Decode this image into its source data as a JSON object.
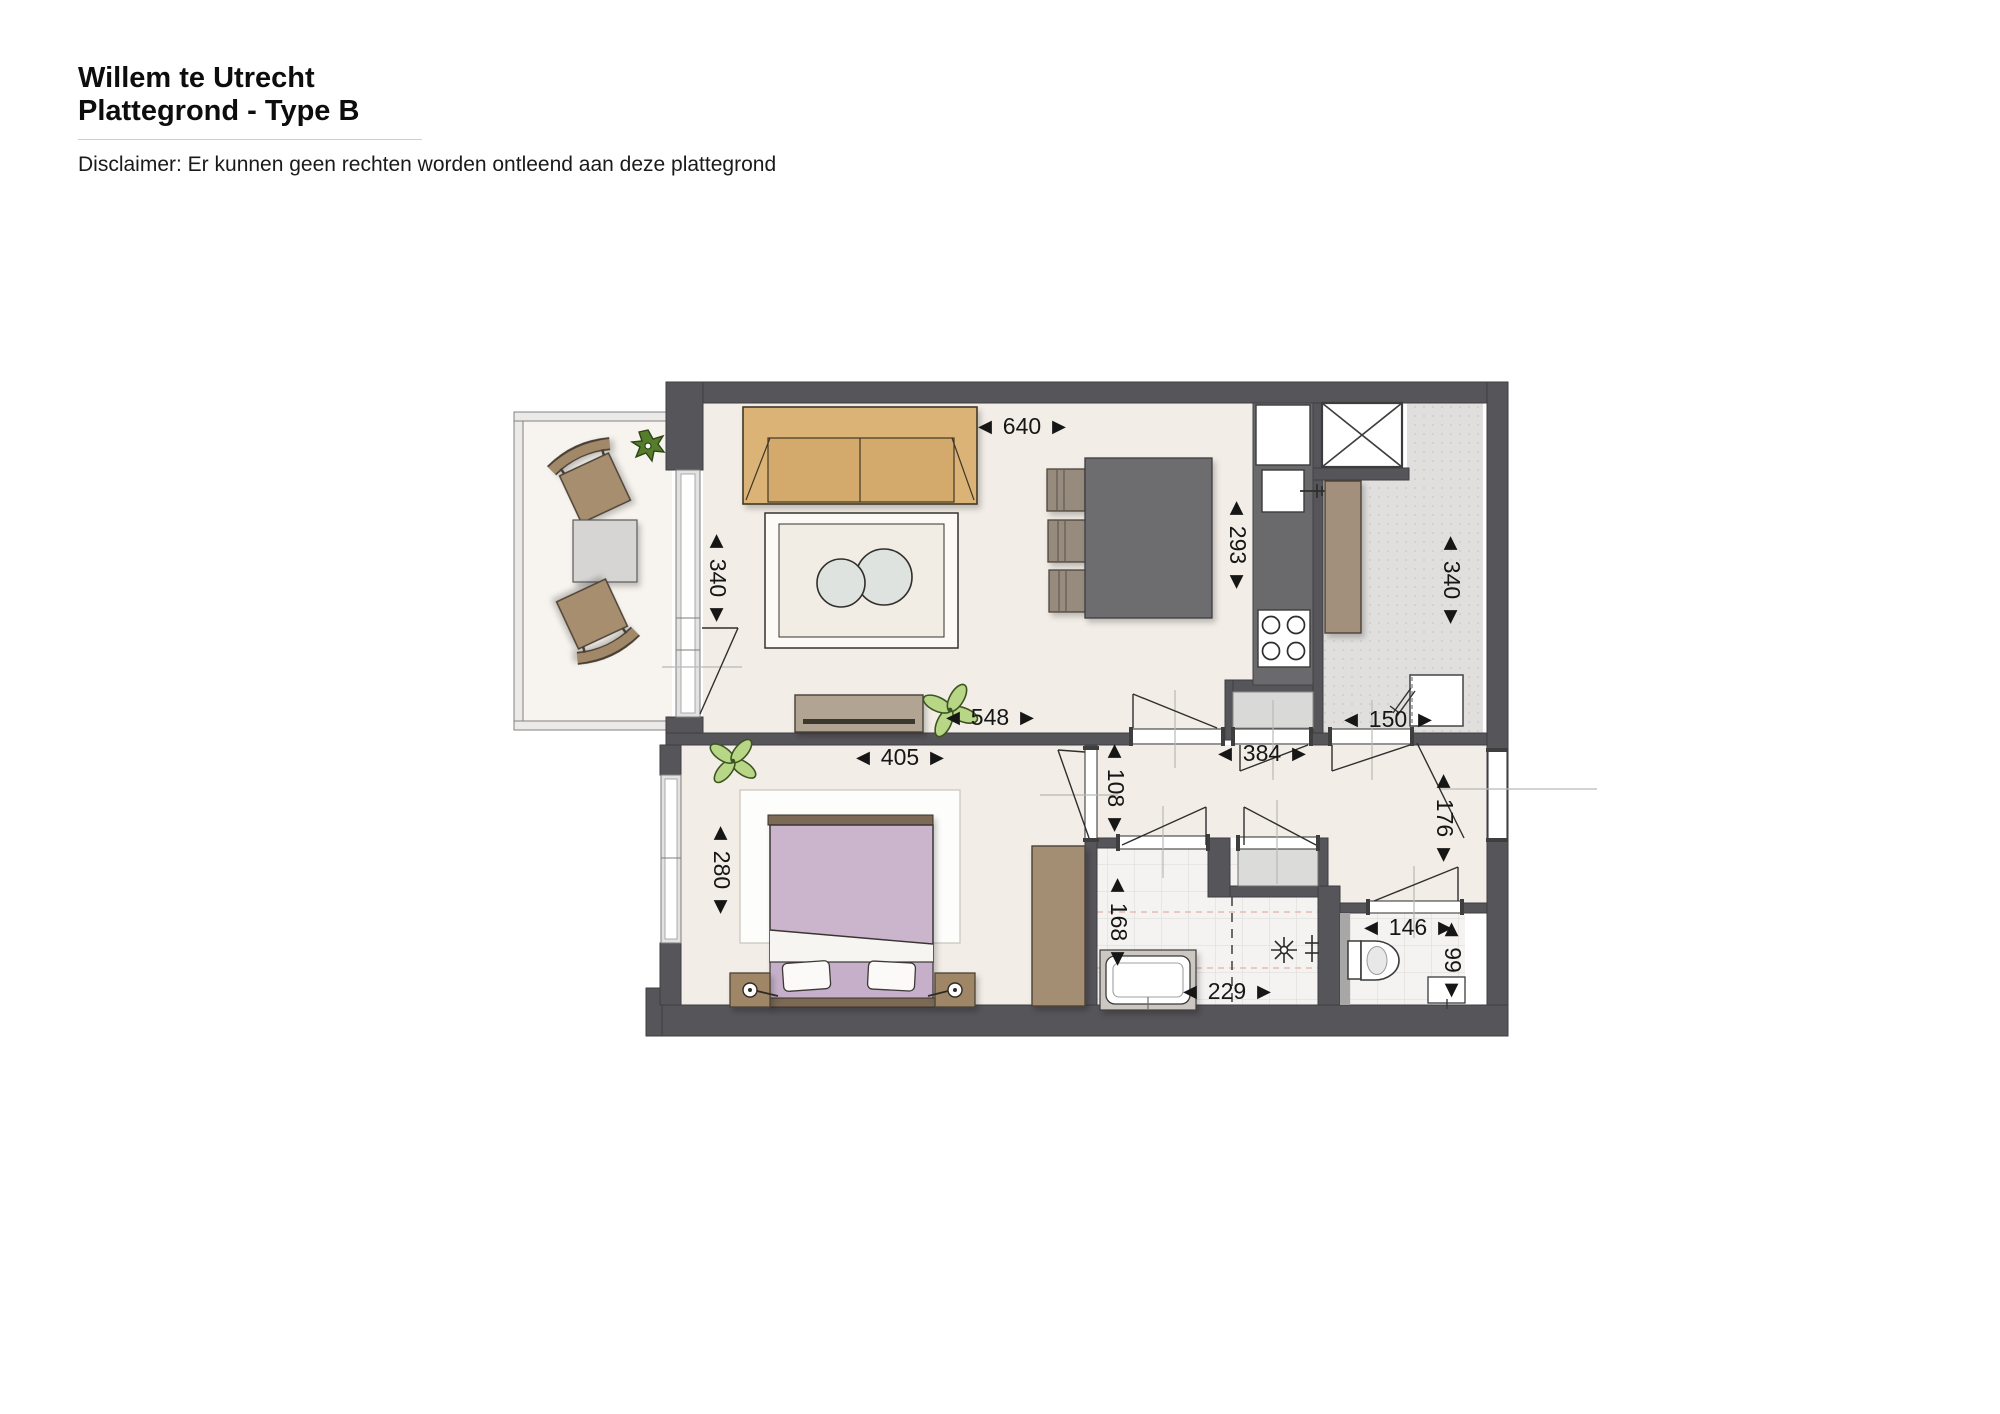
{
  "header": {
    "title_line1": "Willem te Utrecht",
    "title_line2": "Plattegrond - Type B",
    "disclaimer": "Disclaimer: Er kunnen geen rechten worden ontleend aan deze plattegrond"
  },
  "floorplan": {
    "dimension_labels": {
      "living_width": "◄ 640 ►",
      "living_depth": "◄ 340 ►",
      "kitchen_depth": "◄ 293 ►",
      "storage_depth": "◄ 340 ►",
      "living_bottom_span": "◄ 548 ►",
      "washer_niche_width": "◄ 150 ►",
      "bedroom_width": "◄ 405 ►",
      "hall_length": "◄ 384 ►",
      "hall_width": "◄ 108 ►",
      "entry_depth": "◄ 176 ►",
      "bedroom_depth": "◄ 280 ►",
      "bathroom_depth": "◄ 168 ►",
      "toilet_width": "◄ 146 ►",
      "toilet_depth": "◄ 99 ►",
      "bathroom_width": "◄ 229 ►"
    },
    "colors": {
      "wall": "#56555a",
      "floor_cream": "#f2ede6",
      "floor_tile": "#f4f3f1",
      "floor_storage": "#e0dfdd",
      "floor_balcony": "#f7f3ee",
      "sofa_wood": "#dbb377",
      "bed_lilac": "#cab5cd",
      "furniture_brown": "#a48d72",
      "dining_table_gray": "#6d6d6f",
      "plant_green": "#b7d787",
      "plant_dark_green": "#567d2b"
    }
  }
}
